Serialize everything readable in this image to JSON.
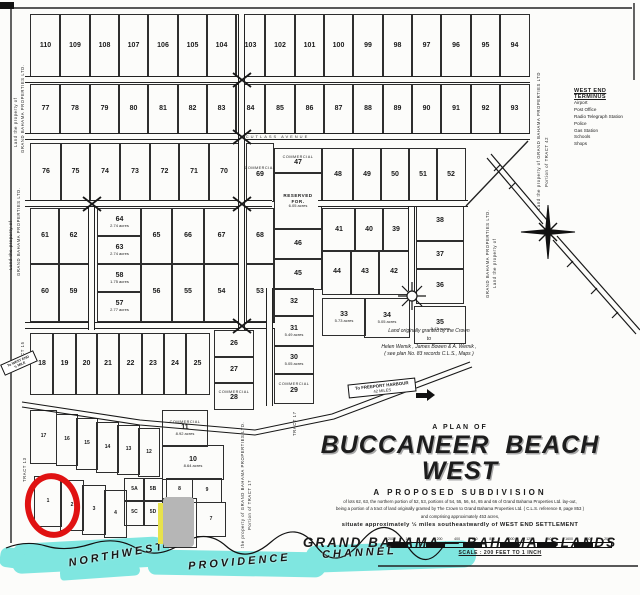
{
  "title_block": {
    "plan_of": "A PLAN OF",
    "title": "BUCCANEER BEACH WEST",
    "subtitle": "A PROPOSED SUBDIVISION",
    "fine_print_1": "of lots 62, 63, the northern portion of 52, 53, portions of 54, 55, 56, 64, 65 and 66 of Grand Bahama Properties Ltd. lay-out,",
    "fine_print_2": "being a portion of a tract of land originally granted by The Crown to Grand Bahama Properties Ltd. ( C.L.S. reference 8, page 853 )",
    "fine_print_3": "and comprising approximately 453 acres,",
    "situate": "situate approximately ½ miles southeastwardly of WEST END SETTLEMENT",
    "location": "GRAND BAHAMA  —  BAHAMA ISLANDS"
  },
  "scale": {
    "caption": "SCALE :  200 FEET TO 1 INCH",
    "ticks": [
      "200",
      "100",
      "0",
      "200",
      "400",
      "600",
      "800",
      "1000",
      "1200",
      "1400",
      "1600",
      "1800",
      "2000"
    ]
  },
  "signs": {
    "freeport_line1": "To  FREEPORT  HARBOUR",
    "freeport_line2": "42  MILES",
    "westend_line1": "To  WEST  END",
    "westend_line2": "½  MILE"
  },
  "terminus": {
    "header": "WEST END TERMINUS",
    "items": [
      "Airport",
      "Post Office",
      "Radio Telegraph Station",
      "Police",
      "Gas Station",
      "Schools",
      "Shops"
    ]
  },
  "notes": {
    "crown_grant": [
      "Land  originally  granted  by  the  Crown",
      "to",
      "Helen  Wemik ,  James  Bowen  &  A.  Wemik ,",
      "( see  plan  No. 83  records  C.L.S.,  Maps )"
    ]
  },
  "labels": {
    "commercial": "COMMERCIAL"
  },
  "colors": {
    "water": "#7fe6e0",
    "grey_patch": "#b6b6b6",
    "highlight_yellow": "#e7e24c",
    "annotation_red": "#e01212",
    "ink": "#1a1a1a"
  },
  "water": {
    "labels": [
      {
        "t": "NORTHWEST",
        "x": 68,
        "y": 549,
        "rot": -10
      },
      {
        "t": "PROVIDENCE",
        "x": 188,
        "y": 556,
        "rot": -5
      },
      {
        "t": "CHANNEL",
        "x": 322,
        "y": 547,
        "rot": -3
      }
    ],
    "shapes": [
      {
        "x": 12,
        "y": 540,
        "w": 158,
        "h": 30,
        "rot": -3
      },
      {
        "x": 148,
        "y": 551,
        "w": 178,
        "h": 25,
        "rot": 1
      },
      {
        "x": 306,
        "y": 543,
        "w": 170,
        "h": 27,
        "rot": -2
      },
      {
        "x": 0,
        "y": 548,
        "w": 26,
        "h": 20,
        "rot": 8
      },
      {
        "x": 60,
        "y": 566,
        "w": 80,
        "h": 12,
        "rot": -4
      }
    ]
  },
  "annotations": {
    "red_circle": {
      "x": 25,
      "y": 473,
      "w": 43,
      "h": 53
    },
    "grey_patch": {
      "x": 163,
      "y": 497,
      "w": 31,
      "h": 50
    },
    "yellow_stripe": {
      "x": 158,
      "y": 503,
      "w": 5,
      "h": 41
    }
  },
  "roads": [
    {
      "x": 25,
      "y": 76,
      "w": 505,
      "h": 7
    },
    {
      "x": 25,
      "y": 133,
      "w": 505,
      "h": 7,
      "label": "CUTLASS   AVENUE"
    },
    {
      "x": 25,
      "y": 200,
      "w": 247,
      "h": 7
    },
    {
      "x": 318,
      "y": 200,
      "w": 150,
      "h": 7
    },
    {
      "x": 25,
      "y": 322,
      "w": 250,
      "h": 7
    },
    {
      "x": 238,
      "y": 14,
      "w": 7,
      "h": 126,
      "v": 1
    },
    {
      "x": 238,
      "y": 140,
      "w": 7,
      "h": 190,
      "v": 1
    },
    {
      "x": 88,
      "y": 207,
      "w": 7,
      "h": 123,
      "v": 1
    },
    {
      "x": 408,
      "y": 207,
      "w": 7,
      "h": 84,
      "v": 1
    },
    {
      "x": 266,
      "y": 288,
      "w": 7,
      "h": 118,
      "v": 1
    }
  ],
  "margin_texts": [
    {
      "t": "Land  the  property  of",
      "x": 13,
      "y": 62,
      "h": 85
    },
    {
      "t": "GRAND  BAHAMA  PROPERTIES  LTD.",
      "x": 20,
      "y": 55,
      "h": 98
    },
    {
      "t": "Land  the  property  of",
      "x": 8,
      "y": 155,
      "h": 115
    },
    {
      "t": "GRAND  BAHAMA  PROPERTIES  LTD.",
      "x": 16,
      "y": 148,
      "h": 128
    },
    {
      "t": "TRACT  15",
      "x": 20,
      "y": 330,
      "h": 36
    },
    {
      "t": "TRACT  13",
      "x": 22,
      "y": 446,
      "h": 36
    },
    {
      "t": "Portion  of  TRACT  42",
      "x": 544,
      "y": 95,
      "h": 92
    },
    {
      "t": "Land  the  property  of  GRAND  BAHAMA  PROPERTIES  LTD",
      "x": 536,
      "y": 82,
      "h": 128
    },
    {
      "t": "Portion  of  TRACT  17",
      "x": 247,
      "y": 446,
      "h": 84
    },
    {
      "t": "the  property  of  GRAND  BAHAMA  PROPERTIES  LTD.",
      "x": 240,
      "y": 436,
      "h": 112
    },
    {
      "t": "TRACT  17",
      "x": 292,
      "y": 404,
      "h": 32
    },
    {
      "t": "Land  the  property  of",
      "x": 492,
      "y": 196,
      "h": 92
    },
    {
      "t": "GRAND  BAHAMA  PROPERTIES  LTD.",
      "x": 485,
      "y": 190,
      "h": 108
    }
  ],
  "lots": [
    {
      "n": "110",
      "x": 30,
      "y": 14,
      "w": 29,
      "h": 62
    },
    {
      "n": "109",
      "x": 59,
      "y": 14,
      "w": 30,
      "h": 62
    },
    {
      "n": "108",
      "x": 89,
      "y": 14,
      "w": 29,
      "h": 62
    },
    {
      "n": "107",
      "x": 118,
      "y": 14,
      "w": 29,
      "h": 62
    },
    {
      "n": "106",
      "x": 147,
      "y": 14,
      "w": 30,
      "h": 62
    },
    {
      "n": "105",
      "x": 177,
      "y": 14,
      "w": 29,
      "h": 62
    },
    {
      "n": "104",
      "x": 206,
      "y": 14,
      "w": 29,
      "h": 62
    },
    {
      "n": "103",
      "x": 235,
      "y": 14,
      "w": 29,
      "h": 62
    },
    {
      "n": "102",
      "x": 264,
      "y": 14,
      "w": 30,
      "h": 62
    },
    {
      "n": "101",
      "x": 294,
      "y": 14,
      "w": 29,
      "h": 62
    },
    {
      "n": "100",
      "x": 323,
      "y": 14,
      "w": 29,
      "h": 62
    },
    {
      "n": "99",
      "x": 352,
      "y": 14,
      "w": 30,
      "h": 62
    },
    {
      "n": "98",
      "x": 382,
      "y": 14,
      "w": 29,
      "h": 62
    },
    {
      "n": "97",
      "x": 411,
      "y": 14,
      "w": 29,
      "h": 62
    },
    {
      "n": "96",
      "x": 440,
      "y": 14,
      "w": 30,
      "h": 62
    },
    {
      "n": "95",
      "x": 470,
      "y": 14,
      "w": 29,
      "h": 62
    },
    {
      "n": "94",
      "x": 499,
      "y": 14,
      "w": 29,
      "h": 62
    },
    {
      "n": "77",
      "x": 30,
      "y": 84,
      "w": 29,
      "h": 49
    },
    {
      "n": "78",
      "x": 59,
      "y": 84,
      "w": 30,
      "h": 49
    },
    {
      "n": "79",
      "x": 89,
      "y": 84,
      "w": 29,
      "h": 49
    },
    {
      "n": "80",
      "x": 118,
      "y": 84,
      "w": 29,
      "h": 49
    },
    {
      "n": "81",
      "x": 147,
      "y": 84,
      "w": 30,
      "h": 49
    },
    {
      "n": "82",
      "x": 177,
      "y": 84,
      "w": 29,
      "h": 49
    },
    {
      "n": "83",
      "x": 206,
      "y": 84,
      "w": 29,
      "h": 49
    },
    {
      "n": "84",
      "x": 235,
      "y": 84,
      "w": 29,
      "h": 49
    },
    {
      "n": "85",
      "x": 264,
      "y": 84,
      "w": 30,
      "h": 49
    },
    {
      "n": "86",
      "x": 294,
      "y": 84,
      "w": 29,
      "h": 49
    },
    {
      "n": "87",
      "x": 323,
      "y": 84,
      "w": 29,
      "h": 49
    },
    {
      "n": "88",
      "x": 352,
      "y": 84,
      "w": 30,
      "h": 49
    },
    {
      "n": "89",
      "x": 382,
      "y": 84,
      "w": 29,
      "h": 49
    },
    {
      "n": "90",
      "x": 411,
      "y": 84,
      "w": 29,
      "h": 49
    },
    {
      "n": "91",
      "x": 440,
      "y": 84,
      "w": 30,
      "h": 49
    },
    {
      "n": "92",
      "x": 470,
      "y": 84,
      "w": 29,
      "h": 49
    },
    {
      "n": "93",
      "x": 499,
      "y": 84,
      "w": 29,
      "h": 49
    },
    {
      "n": "76",
      "x": 30,
      "y": 143,
      "w": 30,
      "h": 57
    },
    {
      "n": "75",
      "x": 60,
      "y": 143,
      "w": 29,
      "h": 57
    },
    {
      "n": "74",
      "x": 89,
      "y": 143,
      "w": 30,
      "h": 57
    },
    {
      "n": "73",
      "x": 119,
      "y": 143,
      "w": 30,
      "h": 57
    },
    {
      "n": "72",
      "x": 149,
      "y": 143,
      "w": 29,
      "h": 57
    },
    {
      "n": "71",
      "x": 178,
      "y": 143,
      "w": 30,
      "h": 57
    },
    {
      "n": "70",
      "x": 208,
      "y": 143,
      "w": 30,
      "h": 57
    },
    {
      "n": "69",
      "x": 246,
      "y": 143,
      "w": 26,
      "h": 57,
      "c": 1
    },
    {
      "n": "68",
      "x": 246,
      "y": 208,
      "w": 26,
      "h": 55
    },
    {
      "n": "53",
      "x": 246,
      "y": 263,
      "w": 26,
      "h": 57
    },
    {
      "n": "61",
      "x": 30,
      "y": 208,
      "w": 28,
      "h": 55
    },
    {
      "n": "62",
      "x": 58,
      "y": 208,
      "w": 29,
      "h": 55
    },
    {
      "n": "64",
      "x": 97,
      "y": 208,
      "w": 43,
      "h": 27,
      "a": "2.74 acres"
    },
    {
      "n": "63",
      "x": 97,
      "y": 235,
      "w": 43,
      "h": 28,
      "a": "2.74 acres"
    },
    {
      "n": "58",
      "x": 97,
      "y": 263,
      "w": 43,
      "h": 28,
      "a": "1.75 acres"
    },
    {
      "n": "57",
      "x": 97,
      "y": 291,
      "w": 43,
      "h": 29,
      "a": "2.77 acres"
    },
    {
      "n": "65",
      "x": 140,
      "y": 208,
      "w": 31,
      "h": 55
    },
    {
      "n": "66",
      "x": 171,
      "y": 208,
      "w": 32,
      "h": 55
    },
    {
      "n": "67",
      "x": 203,
      "y": 208,
      "w": 35,
      "h": 55
    },
    {
      "n": "60",
      "x": 30,
      "y": 263,
      "w": 28,
      "h": 57
    },
    {
      "n": "59",
      "x": 58,
      "y": 263,
      "w": 29,
      "h": 57
    },
    {
      "n": "56",
      "x": 140,
      "y": 263,
      "w": 31,
      "h": 57
    },
    {
      "n": "55",
      "x": 171,
      "y": 263,
      "w": 32,
      "h": 57
    },
    {
      "n": "54",
      "x": 203,
      "y": 263,
      "w": 35,
      "h": 57
    },
    {
      "n": "47",
      "x": 274,
      "y": 148,
      "w": 46,
      "h": 24,
      "c": 1
    },
    {
      "n": "",
      "x": 274,
      "y": 172,
      "w": 46,
      "h": 56,
      "t": [
        "RESERVED",
        "FOR.",
        "6.05 acres"
      ]
    },
    {
      "n": "46",
      "x": 274,
      "y": 228,
      "w": 46,
      "h": 30
    },
    {
      "n": "45",
      "x": 274,
      "y": 258,
      "w": 46,
      "h": 30
    },
    {
      "n": "32",
      "x": 274,
      "y": 288,
      "w": 38,
      "h": 27
    },
    {
      "n": "31",
      "x": 274,
      "y": 315,
      "w": 38,
      "h": 30,
      "a": "5.49 acres"
    },
    {
      "n": "30",
      "x": 274,
      "y": 345,
      "w": 38,
      "h": 28,
      "a": "5.05 acres"
    },
    {
      "n": "29",
      "x": 274,
      "y": 373,
      "w": 38,
      "h": 29,
      "c": 1
    },
    {
      "n": "48",
      "x": 322,
      "y": 148,
      "w": 30,
      "h": 52
    },
    {
      "n": "49",
      "x": 352,
      "y": 148,
      "w": 28,
      "h": 52
    },
    {
      "n": "50",
      "x": 380,
      "y": 148,
      "w": 28,
      "h": 52
    },
    {
      "n": "51",
      "x": 408,
      "y": 148,
      "w": 28,
      "h": 52
    },
    {
      "n": "52",
      "x": 436,
      "y": 148,
      "w": 28,
      "h": 52
    },
    {
      "n": "41",
      "x": 322,
      "y": 208,
      "w": 32,
      "h": 42
    },
    {
      "n": "40",
      "x": 354,
      "y": 208,
      "w": 28,
      "h": 42
    },
    {
      "n": "39",
      "x": 382,
      "y": 208,
      "w": 26,
      "h": 42
    },
    {
      "n": "38",
      "x": 416,
      "y": 200,
      "w": 46,
      "h": 40
    },
    {
      "n": "37",
      "x": 416,
      "y": 240,
      "w": 46,
      "h": 28
    },
    {
      "n": "36",
      "x": 416,
      "y": 268,
      "w": 46,
      "h": 34
    },
    {
      "n": "44",
      "x": 322,
      "y": 250,
      "w": 28,
      "h": 43
    },
    {
      "n": "43",
      "x": 350,
      "y": 250,
      "w": 28,
      "h": 43
    },
    {
      "n": "42",
      "x": 378,
      "y": 250,
      "w": 30,
      "h": 43
    },
    {
      "n": "33",
      "x": 322,
      "y": 298,
      "w": 42,
      "h": 36,
      "a": "5.73 acres"
    },
    {
      "n": "34",
      "x": 364,
      "y": 298,
      "w": 44,
      "h": 38,
      "a": "5.05 acres"
    },
    {
      "n": "35",
      "x": 414,
      "y": 306,
      "w": 50,
      "h": 36,
      "a": "5.43 acres"
    },
    {
      "n": "18",
      "x": 30,
      "y": 333,
      "w": 22,
      "h": 60
    },
    {
      "n": "19",
      "x": 52,
      "y": 333,
      "w": 23,
      "h": 60
    },
    {
      "n": "20",
      "x": 75,
      "y": 333,
      "w": 21,
      "h": 60
    },
    {
      "n": "21",
      "x": 96,
      "y": 333,
      "w": 22,
      "h": 60
    },
    {
      "n": "22",
      "x": 118,
      "y": 333,
      "w": 23,
      "h": 60
    },
    {
      "n": "23",
      "x": 141,
      "y": 333,
      "w": 22,
      "h": 60
    },
    {
      "n": "24",
      "x": 163,
      "y": 333,
      "w": 22,
      "h": 60
    },
    {
      "n": "25",
      "x": 185,
      "y": 333,
      "w": 23,
      "h": 60
    },
    {
      "n": "26",
      "x": 214,
      "y": 330,
      "w": 38,
      "h": 26
    },
    {
      "n": "27",
      "x": 214,
      "y": 356,
      "w": 38,
      "h": 26
    },
    {
      "n": "28",
      "x": 214,
      "y": 382,
      "w": 38,
      "h": 26,
      "c": 1
    },
    {
      "n": "17",
      "x": 30,
      "y": 410,
      "w": 25,
      "h": 52,
      "s": 1
    },
    {
      "n": "16",
      "x": 56,
      "y": 414,
      "w": 20,
      "h": 50,
      "s": 1
    },
    {
      "n": "15",
      "x": 76,
      "y": 418,
      "w": 20,
      "h": 50,
      "s": 1
    },
    {
      "n": "14",
      "x": 96,
      "y": 422,
      "w": 21,
      "h": 49,
      "s": 1
    },
    {
      "n": "13",
      "x": 117,
      "y": 425,
      "w": 21,
      "h": 48,
      "s": 1
    },
    {
      "n": "12",
      "x": 138,
      "y": 428,
      "w": 20,
      "h": 47,
      "s": 1
    },
    {
      "n": "11",
      "x": 162,
      "y": 410,
      "w": 44,
      "h": 35,
      "c": 1,
      "a": "8.92 acres"
    },
    {
      "n": "10",
      "x": 162,
      "y": 445,
      "w": 60,
      "h": 33,
      "a": "8.64 acres"
    },
    {
      "n": "8",
      "x": 166,
      "y": 478,
      "w": 25,
      "h": 21,
      "s": 1
    },
    {
      "n": "9",
      "x": 192,
      "y": 478,
      "w": 28,
      "h": 23,
      "s": 1
    },
    {
      "n": "5A",
      "x": 124,
      "y": 478,
      "w": 19,
      "h": 22,
      "s": 1
    },
    {
      "n": "5B",
      "x": 143,
      "y": 478,
      "w": 18,
      "h": 22,
      "s": 1
    },
    {
      "n": "5C",
      "x": 124,
      "y": 500,
      "w": 19,
      "h": 24,
      "s": 1
    },
    {
      "n": "5D",
      "x": 143,
      "y": 500,
      "w": 18,
      "h": 24,
      "s": 1
    },
    {
      "n": "1",
      "x": 34,
      "y": 476,
      "w": 26,
      "h": 49,
      "s": 1
    },
    {
      "n": "2",
      "x": 60,
      "y": 480,
      "w": 22,
      "h": 49,
      "s": 1
    },
    {
      "n": "3",
      "x": 82,
      "y": 485,
      "w": 22,
      "h": 48,
      "s": 1
    },
    {
      "n": "4",
      "x": 104,
      "y": 490,
      "w": 21,
      "h": 46,
      "s": 1
    },
    {
      "n": "6",
      "x": 163,
      "y": 498,
      "w": 32,
      "h": 48,
      "s": 1
    },
    {
      "n": "7",
      "x": 196,
      "y": 502,
      "w": 28,
      "h": 33,
      "s": 1
    }
  ]
}
